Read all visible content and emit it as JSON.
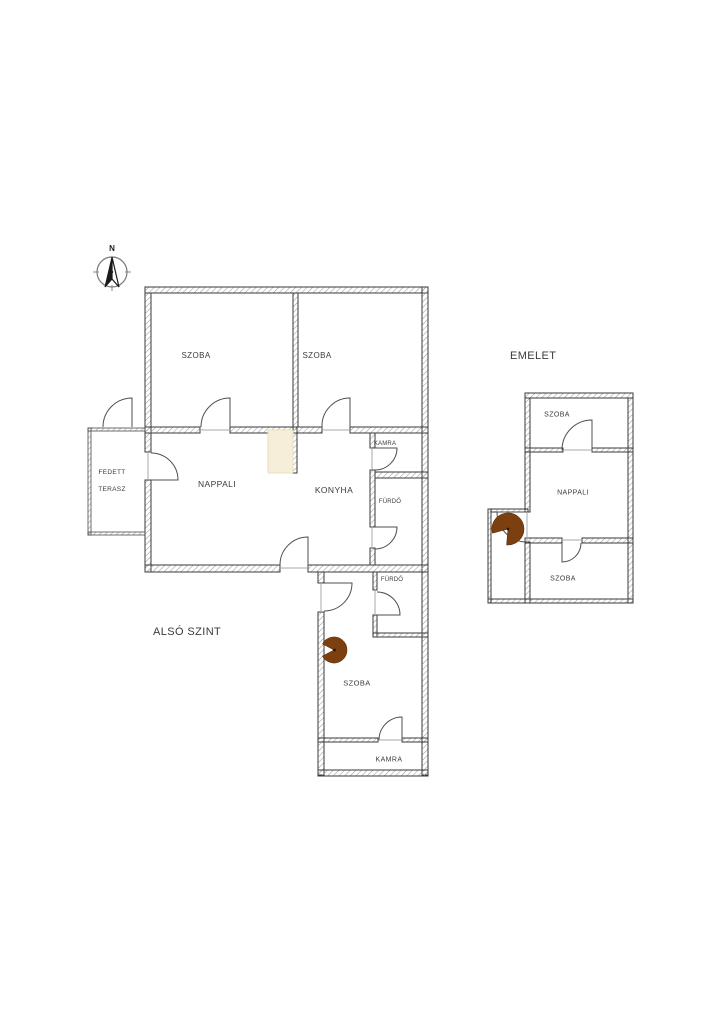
{
  "titles": {
    "lower_floor": "ALSÓ SZINT",
    "upper_floor": "EMELET"
  },
  "compass": {
    "north_label": "N"
  },
  "lower_floor": {
    "rooms": {
      "szoba_top_left": "SZOBA",
      "szoba_top_right": "SZOBA",
      "kamra_top": "KAMRA",
      "nappali": "NAPPALI",
      "konyha": "KONYHA",
      "furdo_upper": "FÜRDŐ",
      "terrace_line1": "FEDETT",
      "terrace_line2": "TERASZ",
      "furdo_lower": "FÜRDŐ",
      "szoba_lower": "SZOBA",
      "kamra_lower": "KAMRA"
    }
  },
  "upper_floor": {
    "rooms": {
      "szoba_top": "SZOBA",
      "nappali": "NAPPALI",
      "szoba_bottom": "SZOBA"
    }
  },
  "colors": {
    "wall_line": "#3A3A3A",
    "hatch_line": "#9A9A9A",
    "door_line": "#4F4F4F",
    "label_text": "#3B3B3B",
    "stove_brown": "#7B3F10",
    "stove_dot": "#2E1804",
    "chimney_fill": "#F6EED9",
    "chimney_border": "#E8DEC2"
  }
}
